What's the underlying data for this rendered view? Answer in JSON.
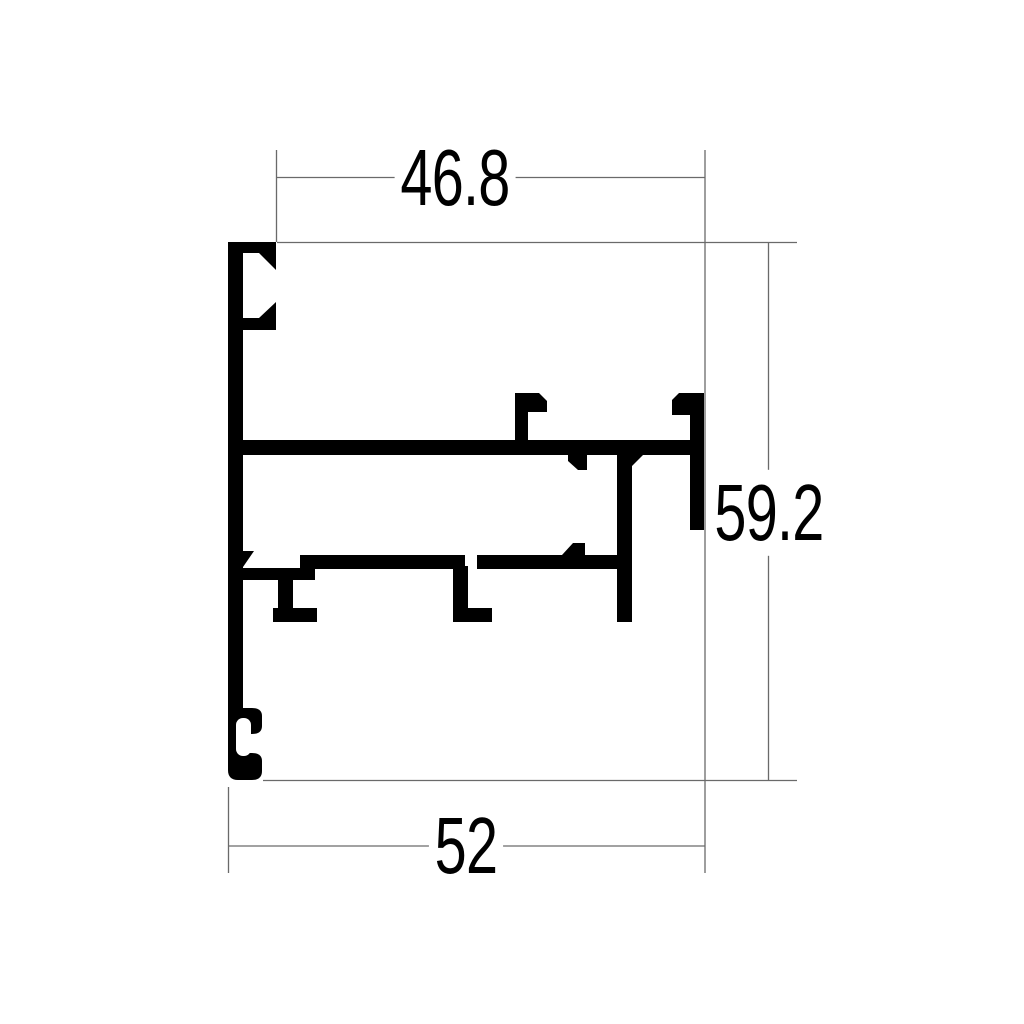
{
  "colors": {
    "ink": "#000000",
    "thin_line": "#6a6a6a",
    "background": "#ffffff"
  },
  "dimensions": {
    "top_width": {
      "value": "46.8",
      "orientation": "horizontal"
    },
    "right_height": {
      "value": "59.2",
      "orientation": "vertical"
    },
    "bottom_width": {
      "value": "52",
      "orientation": "horizontal"
    }
  }
}
